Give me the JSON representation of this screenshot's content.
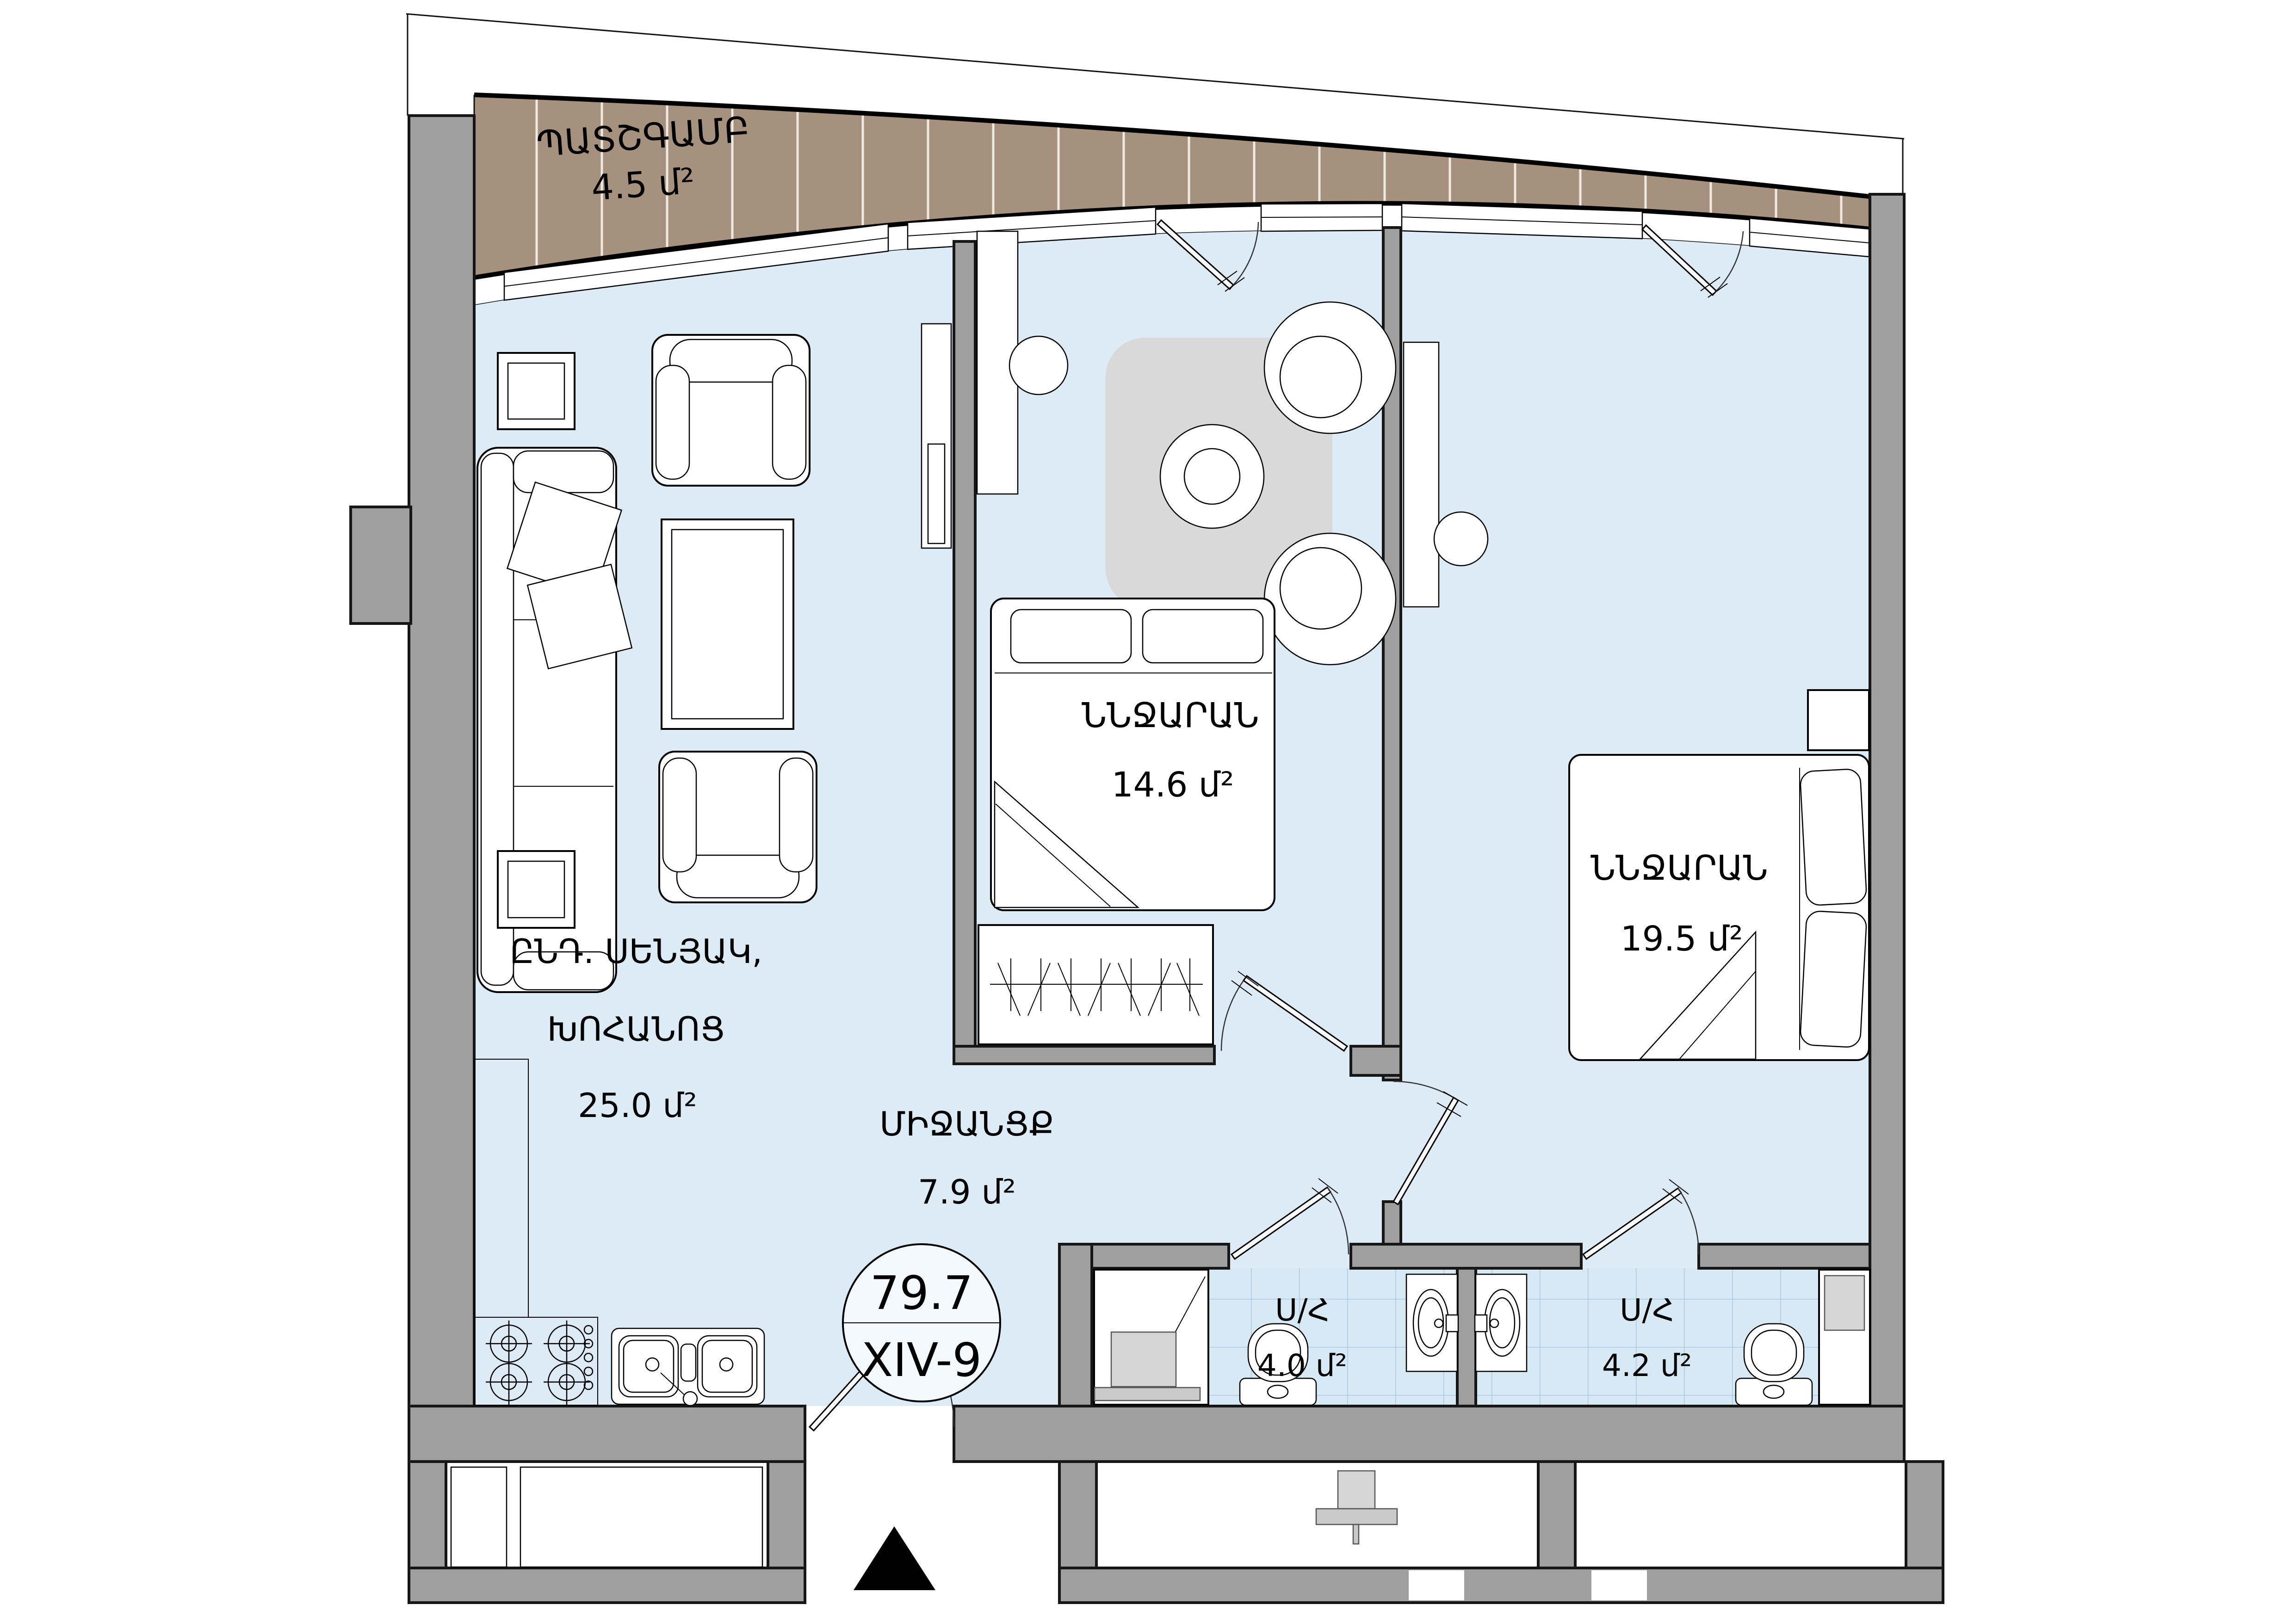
{
  "plan": {
    "rooms": {
      "balcony": {
        "title": "ՊԱՏՇԳԱՄԲ",
        "area": "4.5 մ²"
      },
      "living": {
        "title_line1": "ԸՆԴ. ՍԵՆՅԱԿ,",
        "title_line2": "ԽՈՀԱՆՈՑ",
        "area": "25.0 մ²"
      },
      "bedroom1": {
        "title": "ՆՆՋԱՐԱՆ",
        "area": "14.6 մ²"
      },
      "bedroom2": {
        "title": "ՆՆՋԱՐԱՆ",
        "area": "19.5 մ²"
      },
      "corridor": {
        "title": "ՄԻՋԱՆՑՔ",
        "area": "7.9 մ²"
      },
      "bathroom1": {
        "title": "Ս/Հ",
        "area": "4.0 մ²"
      },
      "bathroom2": {
        "title": "Ս/Հ",
        "area": "4.2 մ²"
      }
    },
    "badge": {
      "total_area": "79.7",
      "unit": "XIV-9"
    },
    "colors": {
      "floor": "#dcebf6",
      "wall": "#9f9f9f",
      "balcony": "#a5917e",
      "tile": "#d7e9f5",
      "tile_line": "#a9c9de",
      "rug": "#d9d9d9"
    }
  }
}
